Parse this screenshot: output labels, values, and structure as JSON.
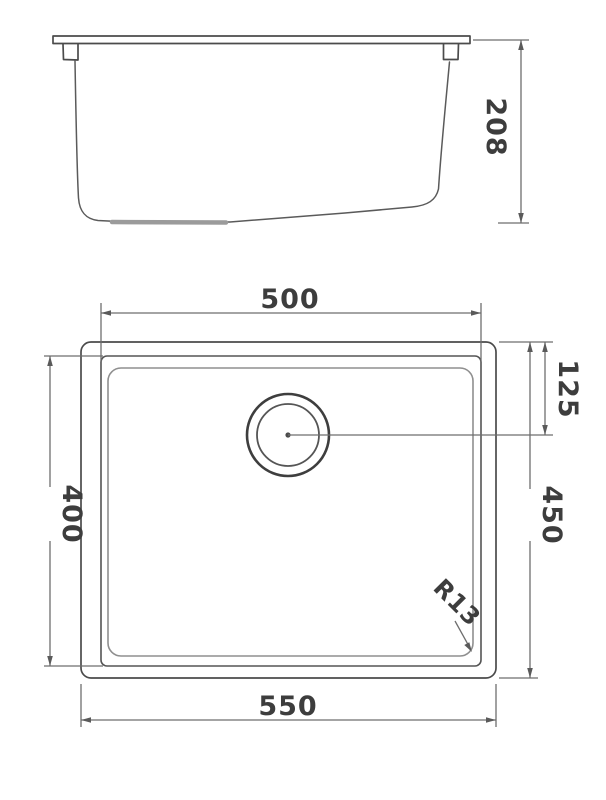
{
  "meta": {
    "subject": "undermount sink technical drawing",
    "background_color": "#ffffff",
    "geometry_line_color": "#4b4b4b",
    "dimension_line_color": "#6e6e6e",
    "text_color": "#3d3d3d"
  },
  "side_view": {
    "name": "side elevation",
    "height_dim": "208"
  },
  "plan_view": {
    "name": "top plan",
    "inner_width_dim": "500",
    "drain_offset_dim": "125",
    "inner_depth_dim": "400",
    "overall_depth_dim": "450",
    "corner_radius_dim": "R13",
    "overall_width_dim": "550"
  }
}
